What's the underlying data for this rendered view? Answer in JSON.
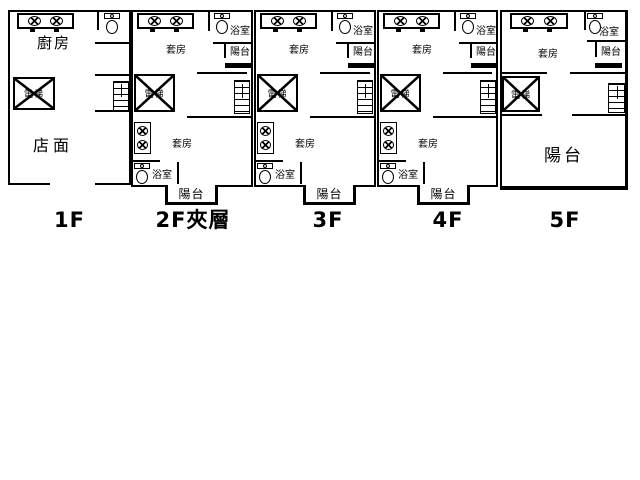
{
  "drawing": {
    "type": "building-floor-plan",
    "colors": {
      "line": "#000000",
      "background": "#ffffff",
      "railing_bar": "#000000"
    }
  },
  "floors": [
    {
      "caption": "1F",
      "kitchen": "廚房",
      "store": "店面",
      "elevator": "電梯"
    },
    {
      "caption": "2F夾層",
      "suite_top": "套房",
      "bath_top": "浴室",
      "balcony_top": "陽台",
      "elevator": "電梯",
      "suite_lower": "套房",
      "bath_lower": "浴室",
      "balcony_lower": "陽台"
    },
    {
      "caption": "3F",
      "suite_top": "套房",
      "bath_top": "浴室",
      "balcony_top": "陽台",
      "elevator": "電梯",
      "suite_lower": "套房",
      "bath_lower": "浴室",
      "balcony_lower": "陽台"
    },
    {
      "caption": "4F",
      "suite_top": "套房",
      "bath_top": "浴室",
      "balcony_top": "陽台",
      "elevator": "電梯",
      "suite_lower": "套房",
      "bath_lower": "浴室",
      "balcony_lower": "陽台"
    },
    {
      "caption": "5F",
      "suite_top": "套房",
      "bath_top": "浴室",
      "balcony_top": "陽台",
      "elevator": "電梯",
      "balcony_main": "陽台"
    }
  ]
}
